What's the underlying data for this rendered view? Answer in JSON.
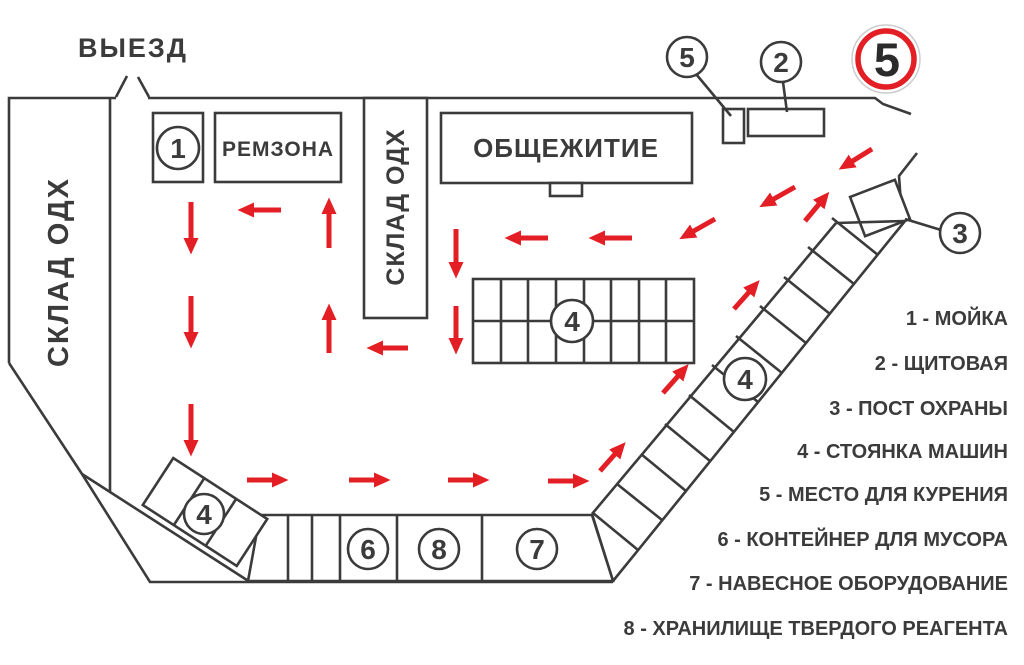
{
  "colors": {
    "line": "#3b3b3b",
    "red": "#e31e24",
    "background": "#ffffff"
  },
  "exit_label": "ВЫЕЗД",
  "speed_sign": {
    "value": "5"
  },
  "buildings": {
    "warehouse_left": "СКЛАД ОДХ",
    "repair_zone": "РЕМЗОНА",
    "warehouse_center": "СКЛАД ОДХ",
    "dormitory": "ОБЩЕЖИТИЕ"
  },
  "markers": {
    "wash": "1",
    "switchboard": "2",
    "guard_post": "3",
    "parking": "4",
    "smoking": "5",
    "trash_container": "6",
    "mounted_equipment": "7",
    "solid_reagent_storage": "8"
  },
  "legend": {
    "items": [
      {
        "label": "1 - МОЙКА"
      },
      {
        "label": "2 - ЩИТОВАЯ"
      },
      {
        "label": "3 - ПОСТ ОХРАНЫ"
      },
      {
        "label": "4 - СТОЯНКА МАШИН"
      },
      {
        "label": "5 - МЕСТО ДЛЯ КУРЕНИЯ"
      },
      {
        "label": "6 - КОНТЕЙНЕР ДЛЯ МУСОРА"
      },
      {
        "label": "7 - НАВЕСНОЕ ОБОРУДОВАНИЕ"
      },
      {
        "label": "8 - ХРАНИЛИЩЕ ТВЕРДОГО РЕАГЕНТА"
      }
    ]
  }
}
